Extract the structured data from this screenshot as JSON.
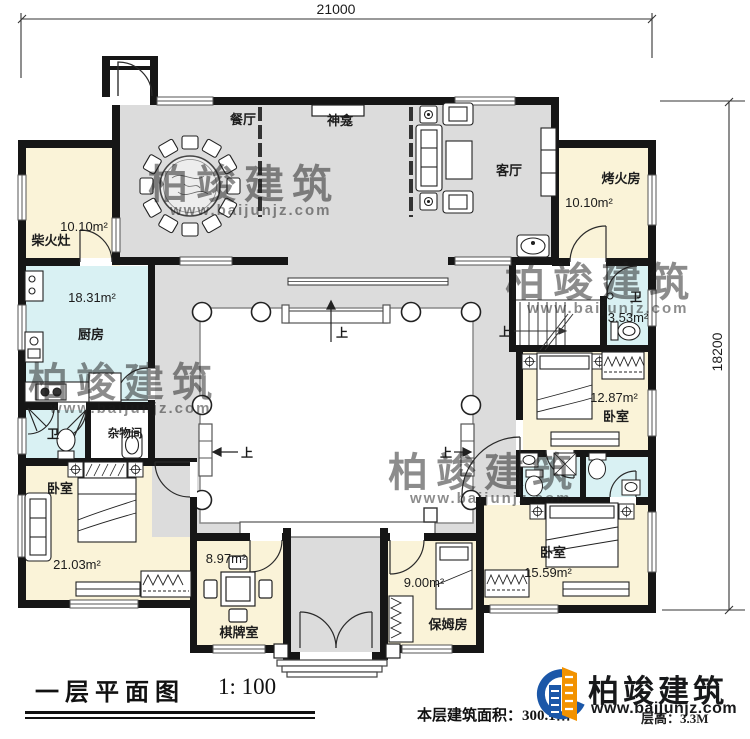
{
  "dimensions": {
    "top": "21000",
    "right": "18200"
  },
  "rooms": {
    "dining": {
      "name": "餐厅"
    },
    "shrine": {
      "name": "神龛"
    },
    "living": {
      "name": "客厅"
    },
    "fire_room": {
      "name": "烤火房",
      "area": "10.10m²"
    },
    "firewood_stove": {
      "name": "柴火灶",
      "area": "10.10m²"
    },
    "kitchen": {
      "name": "厨房",
      "area": "18.31m²"
    },
    "bath_left": {
      "name": "卫"
    },
    "storage": {
      "name": "杂物间"
    },
    "bath_stairs": {
      "name": "卫",
      "area": "3.53m²"
    },
    "bedroom_mid_right": {
      "name": "卧室",
      "area": "12.87m²"
    },
    "bedroom_left": {
      "name": "卧室",
      "area": "21.03m²"
    },
    "chess_room": {
      "name": "棋牌室",
      "area": "8.97m²"
    },
    "nanny_room": {
      "name": "保姆房",
      "area": "9.00m²"
    },
    "bedroom_bottom_right": {
      "name": "卧室",
      "area": "15.59m²"
    }
  },
  "annotations": {
    "up": "上"
  },
  "watermark": {
    "brand": "柏竣建筑",
    "site": "www.baijunjz.com"
  },
  "footer": {
    "plan_title": "一层平面图",
    "scale": "1: 100",
    "area_text": "本层建筑面积：300.1㎡",
    "height_text": "层高：3.3M"
  },
  "logo": {
    "brand": "柏竣建筑",
    "site": "www.baijunjz.com"
  },
  "colors": {
    "floor_gray": "#dcdcdc",
    "room_cream": "#faf3d8",
    "room_cyan": "#d9f1f3",
    "wall": "#161616",
    "logo_blue": "#1b57a8",
    "logo_orange": "#f29200"
  }
}
